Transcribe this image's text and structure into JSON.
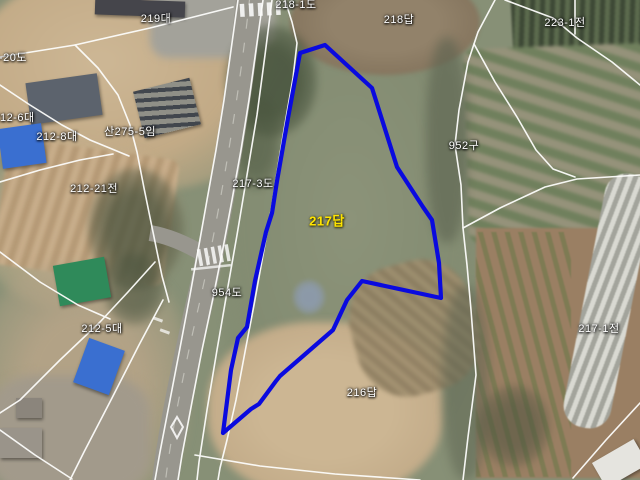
{
  "map": {
    "type": "satellite-cadastral-view",
    "highlighted_parcel_label": "217답",
    "colors": {
      "highlight_outline": "#0a0adf",
      "boundary_line": "#ffffff",
      "label_text": "#ffffff",
      "highlight_label_text": "#ffe400"
    },
    "labels": [
      {
        "text": "219대"
      },
      {
        "text": "218-1도"
      },
      {
        "text": "218답"
      },
      {
        "text": "223-1전"
      },
      {
        "text": "212-20도"
      },
      {
        "text": "212-6대"
      },
      {
        "text": "212-8대"
      },
      {
        "text": "산275-5임"
      },
      {
        "text": "212-21전"
      },
      {
        "text": "217-3도"
      },
      {
        "text": "952구"
      },
      {
        "text": "217답"
      },
      {
        "text": "954도"
      },
      {
        "text": "212-5대"
      },
      {
        "text": "216답"
      },
      {
        "text": "217-1전"
      }
    ],
    "highlight": {
      "points": "325,45 372,88 397,167 423,207 432,220 439,263 441,298 362,281 347,300 333,330 280,376 276,381 259,404 251,409 223,433 231,370 238,338 247,327 255,281 266,232 272,213 277,181 288,118 300,53"
    },
    "boundaries": [
      {
        "points": "238,0 231,50 224,100 216,150 207,200 199,245 190,295 180,348 170,400 160,452 155,480"
      },
      {
        "points": "263,0 256,50 249,100 241,150 232,200 223,248 213,298 202,350 192,402 182,455 178,480"
      },
      {
        "points": "272,0 265,55 257,115 247,175 237,235 227,292 217,350 207,410 199,462 197,480"
      },
      {
        "points": "285,0 292,22 297,43 293,78 286,118 279,160 272,205 263,255 254,305 245,352 236,400 227,440 220,468 218,480"
      },
      {
        "points": "0,57 75,45 150,28 233,7"
      },
      {
        "points": "75,45 98,68 118,95 130,125 137,152 144,188 153,232 162,276 169,302"
      },
      {
        "points": "0,85 30,105 62,125 90,140 112,149 129,156"
      },
      {
        "points": "0,182 40,170 80,160 113,154"
      },
      {
        "points": "0,252 40,282 78,305 110,319"
      },
      {
        "points": "155,262 128,292 100,322 60,360 20,400 0,413"
      },
      {
        "points": "163,300 139,345 112,398 84,452 70,480"
      },
      {
        "points": "0,430 35,455 72,479"
      },
      {
        "points": "495,0 478,32 468,62 459,110 455,145 461,185 463,228 467,265 471,310 476,375 468,437 463,480"
      },
      {
        "points": "463,228 500,208 545,187 577,179 640,175"
      },
      {
        "points": "474,44 495,82 517,117 536,150 553,169 575,177"
      },
      {
        "points": "505,0 553,18 577,38 612,62 640,85"
      },
      {
        "points": "575,0 575,34"
      },
      {
        "points": "640,403 606,440 573,478"
      },
      {
        "points": "195,455 260,466 335,474 420,480"
      }
    ]
  }
}
